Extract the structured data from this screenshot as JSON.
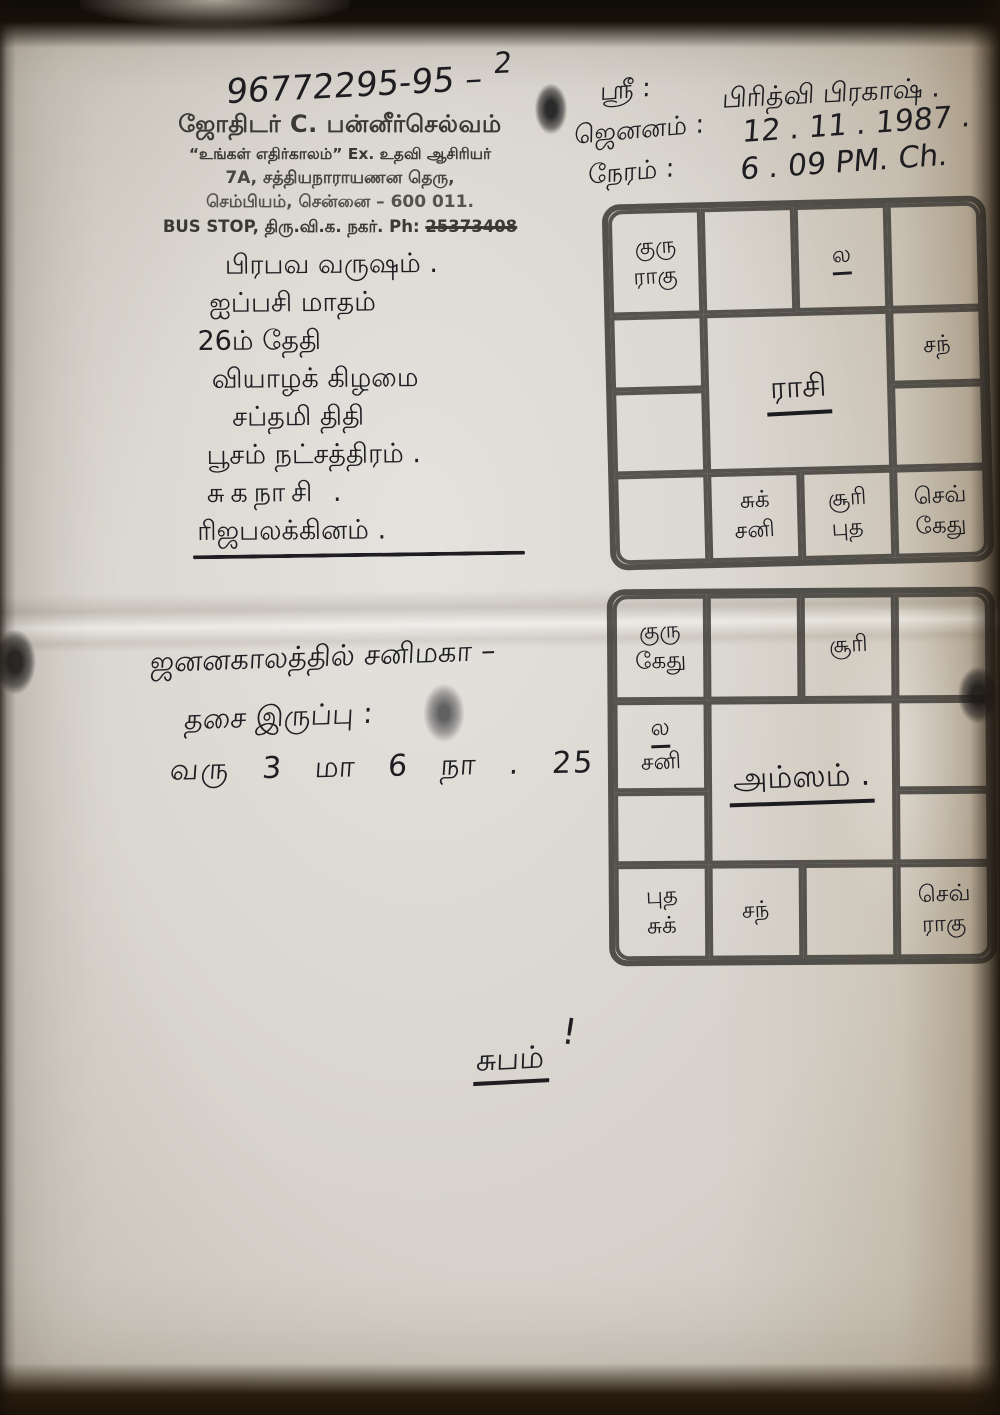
{
  "header": {
    "handwritten_number": "96772295-95 –",
    "handwritten_number_sup": "2",
    "letterhead": {
      "name": "ஜோதிடர் C. பன்னீர்செல்வம்",
      "tagline": "“உங்கள் எதிர்காலம்” Ex. உதவி ஆசிரியர்",
      "address_line1": "7A, சத்தியநாராயணன தெரு,",
      "address_line2": "செம்பியம், சென்னை – 600 011.",
      "bus_stop_prefix": "BUS STOP, திரு.வி.க. நகர். Ph: ",
      "phone_struck": "25373408"
    },
    "details": {
      "rows": [
        {
          "label": "ஸ்ரீ :",
          "value": "பிரித்வி பிரகாஷ் ."
        },
        {
          "label": "ஜெனனம் :",
          "value": "12 . 11 . 1987 ."
        },
        {
          "label": "நேரம் :",
          "value": "6 . 09 PM. Ch."
        }
      ]
    }
  },
  "panchangam_notes": [
    "பிரபவ வருஷம் .",
    "ஐப்பசி மாதம்",
    "26ம் தேதி",
    "வியாழக் கிழமை",
    "சப்தமி திதி",
    "பூசம் நட்சத்திரம் .",
    "சுகநாசி .",
    "ரிஜபலக்கினம் ."
  ],
  "charts": [
    {
      "title": "ராசி",
      "cells": {
        "r1c1": [
          "குரு",
          "ராகு"
        ],
        "r1c2": [],
        "r1c3": [
          "ல"
        ],
        "r1c4": [],
        "r2c1": [],
        "r2c4": [
          "சந்"
        ],
        "r3c1": [],
        "r3c4": [],
        "r4c1": [],
        "r4c2": [
          "சுக்",
          "சனி"
        ],
        "r4c3": [
          "சூரி",
          "புத"
        ],
        "r4c4": [
          "செவ்",
          "கேது"
        ]
      }
    },
    {
      "title": "அம்ஸம் .",
      "cells": {
        "r1c1": [
          "குரு",
          "கேது"
        ],
        "r1c2": [],
        "r1c3": [
          "சூரி"
        ],
        "r1c4": [],
        "r2c1": [
          "ல",
          "சனி"
        ],
        "r2c4": [],
        "r3c1": [],
        "r3c4": [],
        "r4c1": [
          "புத",
          "சுக்"
        ],
        "r4c2": [
          "சந்"
        ],
        "r4c3": [],
        "r4c4": [
          "செவ்",
          "ராகு"
        ]
      }
    }
  ],
  "dasa_note": {
    "line1": "ஜனனகாலத்தில் சனிமகா –",
    "line2": "தசை இருப்பு :",
    "line3": "வரு 3 மா 6 நா . 25"
  },
  "closing": {
    "text": "சுபம்",
    "mark": "!"
  },
  "colors": {
    "ink": "#1e1e22",
    "paper": "#d7d3cc",
    "chart_line": "#3e3c37"
  }
}
